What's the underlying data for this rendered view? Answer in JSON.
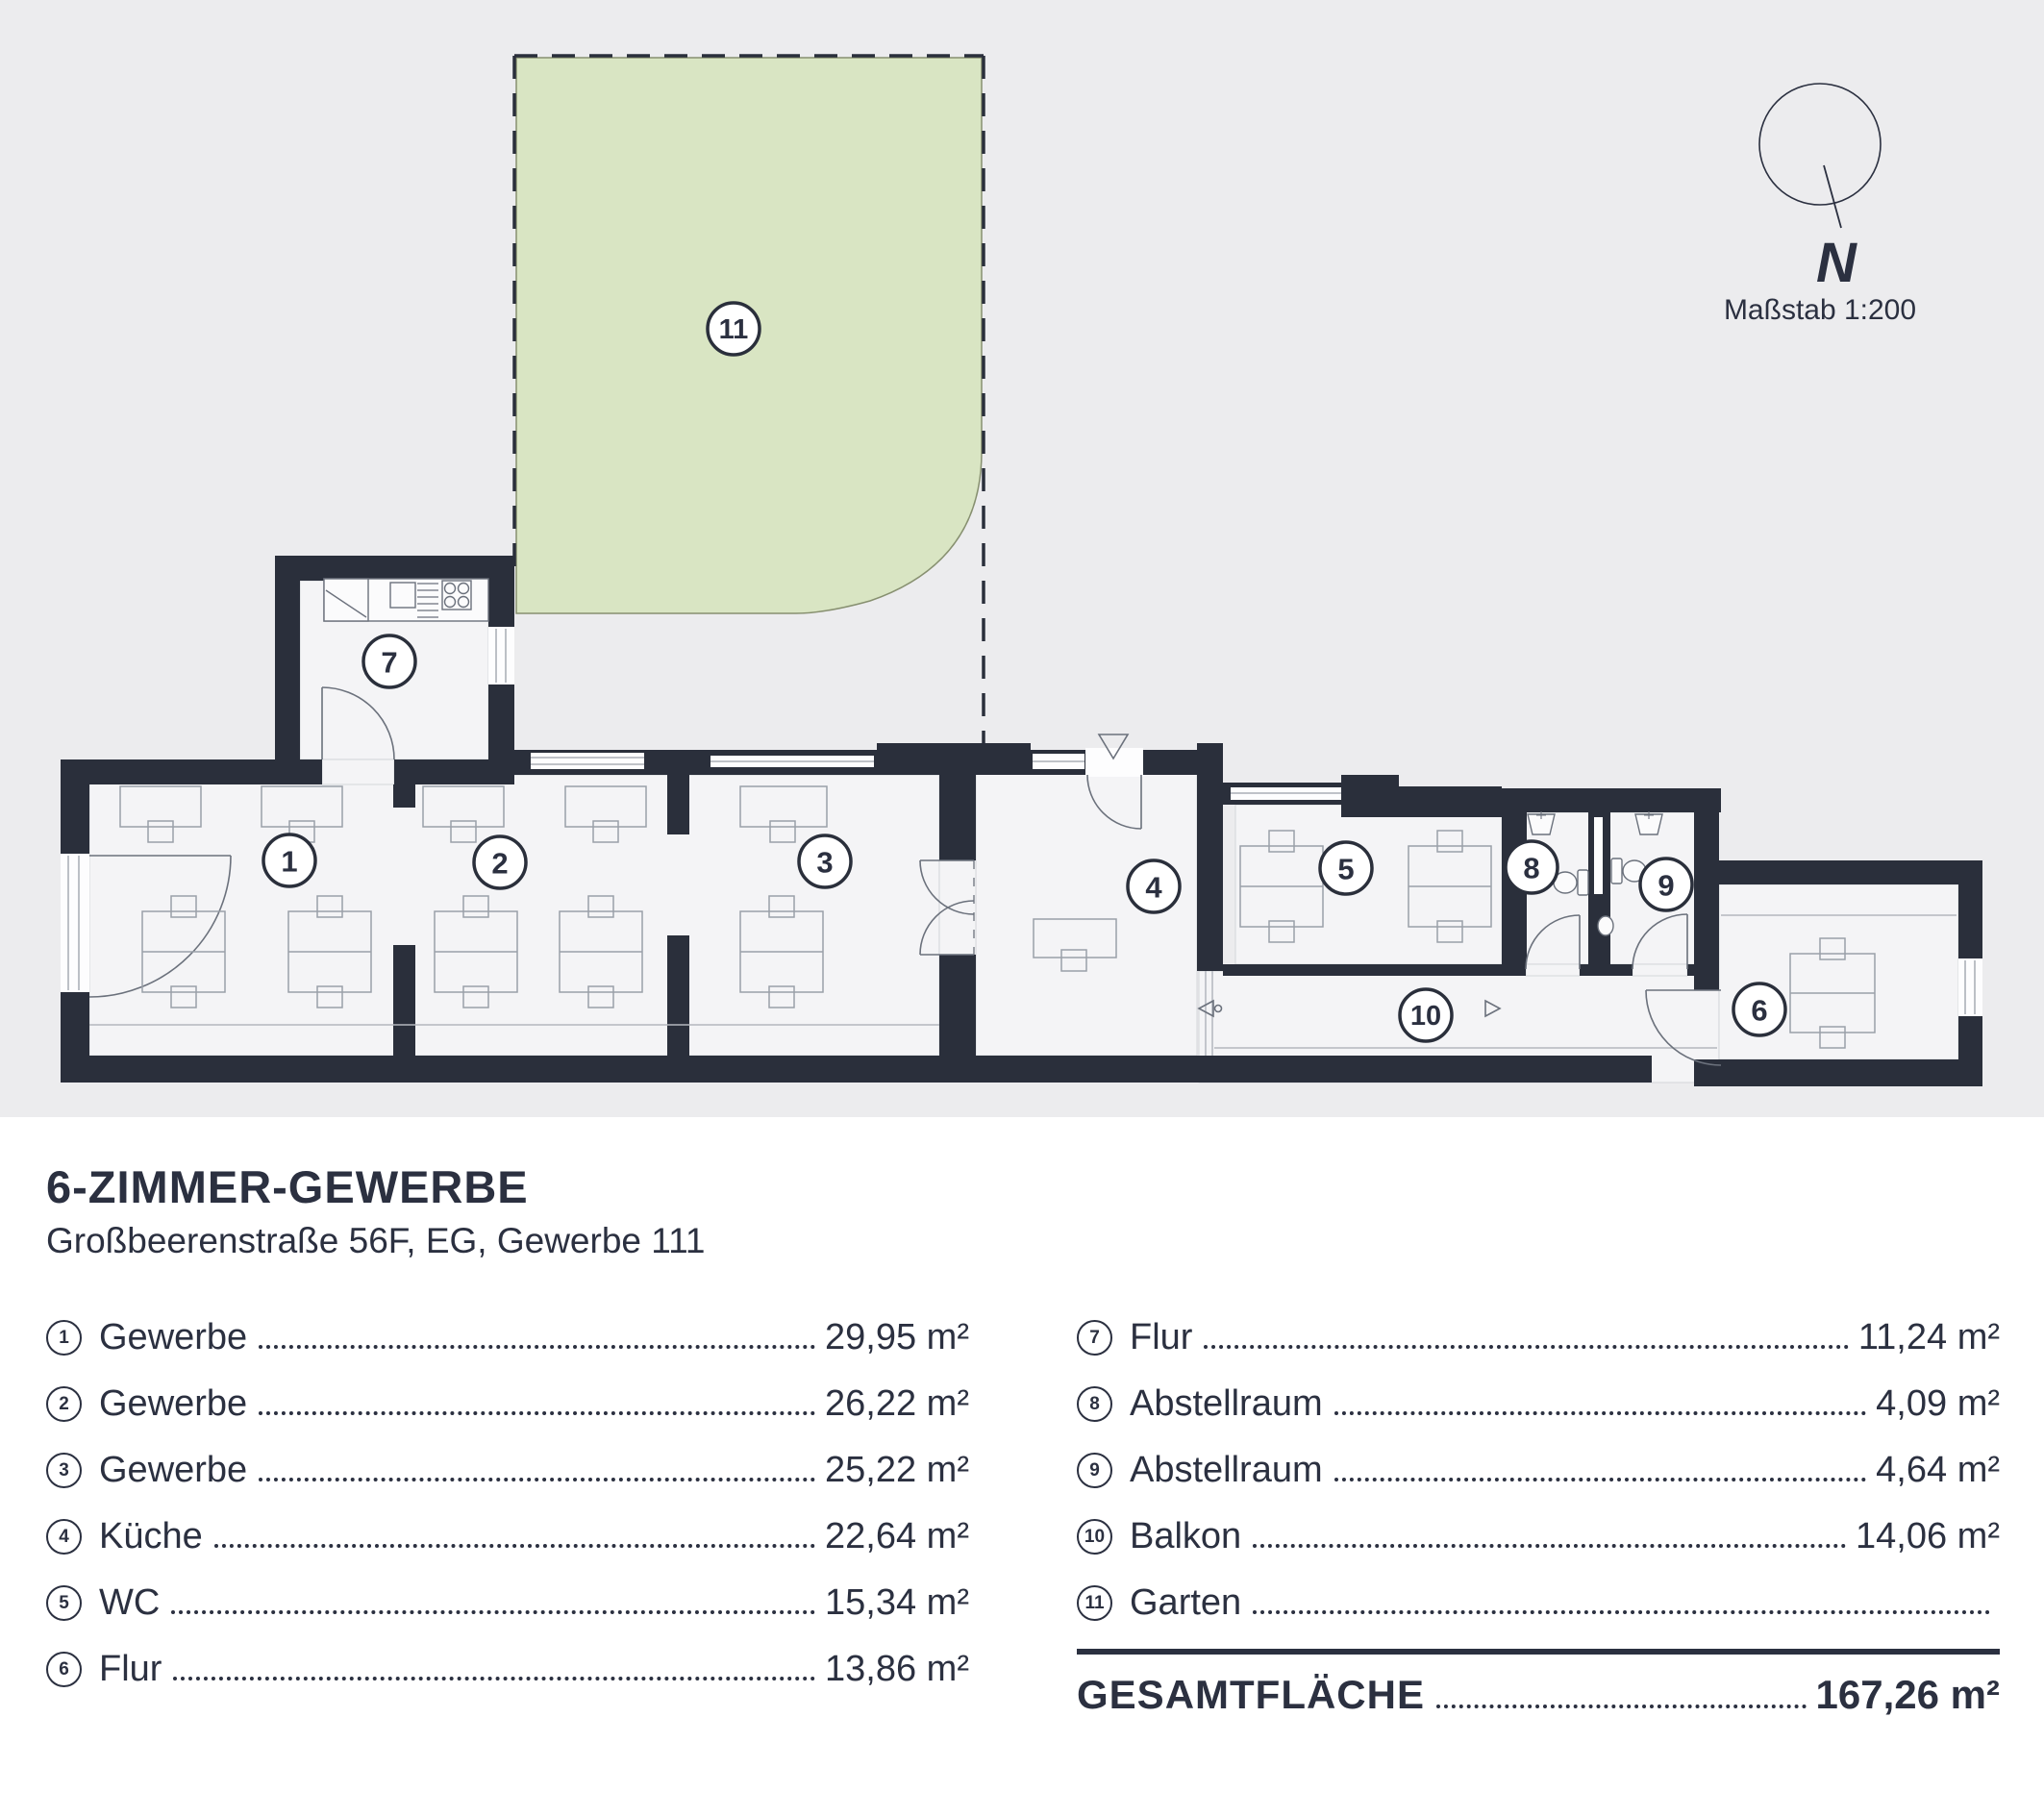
{
  "colors": {
    "wall": "#2a2f3b",
    "ink": "#2b3040",
    "panel_background": "#ececee",
    "room_fill": "#f4f4f6",
    "garden_fill": "#d9e5c3",
    "garden_stroke": "#879070",
    "furniture_line": "#9aa0a8"
  },
  "plan": {
    "north_letter": "N",
    "scale_label": "Maßstab 1:200",
    "room_labels": [
      "1",
      "2",
      "3",
      "4",
      "5",
      "6",
      "7",
      "8",
      "9",
      "10",
      "11"
    ]
  },
  "header": {
    "title": "6-ZIMMER-GEWERBE",
    "subtitle": "Großbeerenstraße 56F, EG, Gewerbe 111"
  },
  "legend": {
    "left": [
      {
        "num": "1",
        "label": "Gewerbe",
        "value": "29,95 m²"
      },
      {
        "num": "2",
        "label": "Gewerbe",
        "value": "26,22 m²"
      },
      {
        "num": "3",
        "label": "Gewerbe",
        "value": "25,22 m²"
      },
      {
        "num": "4",
        "label": "Küche",
        "value": "22,64 m²"
      },
      {
        "num": "5",
        "label": "WC",
        "value": "15,34 m²"
      },
      {
        "num": "6",
        "label": "Flur",
        "value": "13,86 m²"
      }
    ],
    "right": [
      {
        "num": "7",
        "label": "Flur",
        "value": "11,24 m²"
      },
      {
        "num": "8",
        "label": "Abstellraum",
        "value": "4,09 m²"
      },
      {
        "num": "9",
        "label": "Abstellraum",
        "value": "4,64 m²"
      },
      {
        "num": "10",
        "label": "Balkon",
        "value": "14,06 m²"
      },
      {
        "num": "11",
        "label": "Garten",
        "value": ""
      }
    ],
    "total_label": "GESAMTFLÄCHE",
    "total_value": "167,26 m²"
  }
}
